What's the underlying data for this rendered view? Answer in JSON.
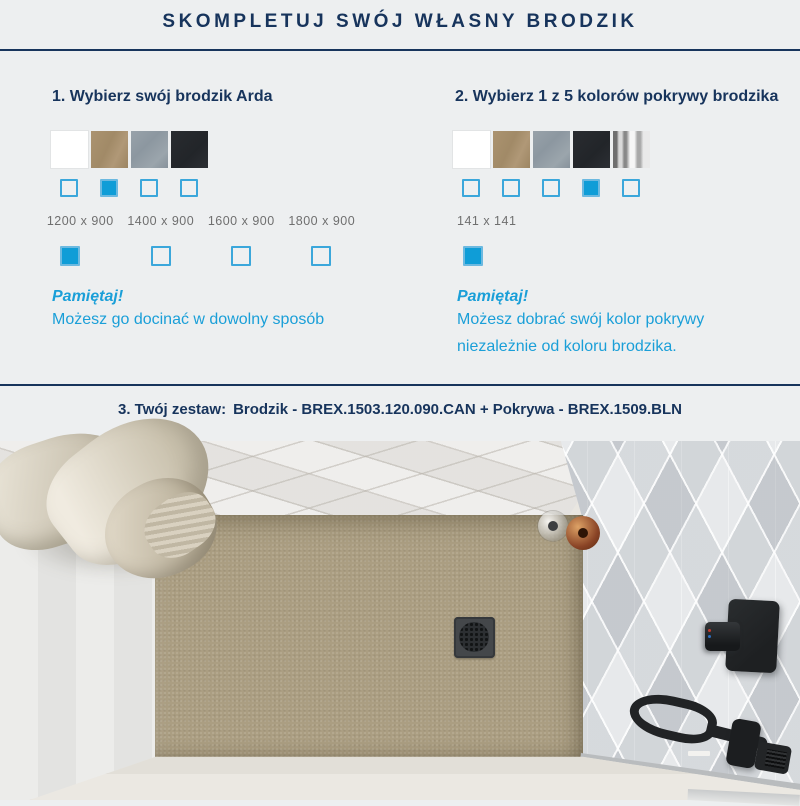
{
  "header": {
    "title": "SKOMPLETUJ SWÓJ WŁASNY BRODZIK"
  },
  "colors": {
    "navy": "#17345c",
    "accent_cyan": "#0f9dd7",
    "checkbox_border": "#3ba7db",
    "size_text_gray": "#6f6f6f",
    "background": "#edeff0",
    "tray_beige": "#ab9e82"
  },
  "step1": {
    "heading": "1. Wybierz swój brodzik Arda",
    "swatches": [
      {
        "name": "white",
        "color": "#ffffff"
      },
      {
        "name": "tan",
        "color": "#a58d6a"
      },
      {
        "name": "gray",
        "color": "#919ca4"
      },
      {
        "name": "black",
        "color": "#25282c"
      }
    ],
    "color_checks": [
      false,
      true,
      false,
      false
    ],
    "sizes": [
      {
        "label": "1200 x 900",
        "checked": true
      },
      {
        "label": "1400 x 900",
        "checked": false
      },
      {
        "label": "1600 x 900",
        "checked": false
      },
      {
        "label": "1800 x 900",
        "checked": false
      }
    ],
    "reminder_title": "Pamiętaj!",
    "reminder_text": "Możesz go docinać w dowolny sposób"
  },
  "step2": {
    "heading": "2. Wybierz 1 z 5 kolorów pokrywy brodzika",
    "swatches": [
      {
        "name": "white",
        "color": "#ffffff"
      },
      {
        "name": "tan",
        "color": "#a58d6a"
      },
      {
        "name": "gray",
        "color": "#919ca4"
      },
      {
        "name": "black",
        "color": "#25282c"
      },
      {
        "name": "chrome",
        "color": "#c0c0c0"
      }
    ],
    "color_checks": [
      false,
      false,
      false,
      true,
      false
    ],
    "sizes": [
      {
        "label": "141 x 141",
        "checked": true
      }
    ],
    "reminder_title": "Pamiętaj!",
    "reminder_line1": "Możesz dobrać swój kolor pokrywy",
    "reminder_line2": "niezależnie od koloru brodzika."
  },
  "step3": {
    "prefix": "3. Twój zestaw:",
    "set_text": "Brodzik - BREX.1503.120.090.CAN + Pokrywa - BREX.1509.BLN"
  }
}
